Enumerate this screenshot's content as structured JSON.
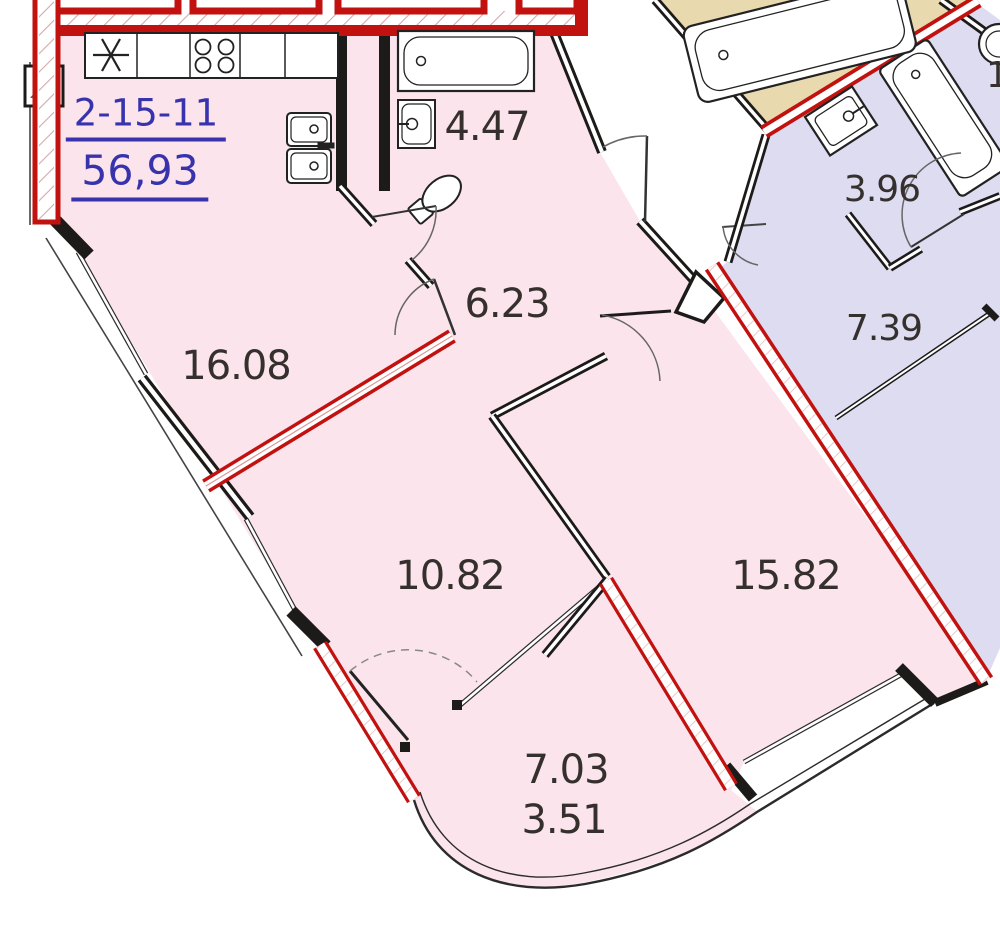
{
  "plan": {
    "unit": {
      "id": "2-15-11",
      "total_area": "56,93"
    },
    "rooms": [
      {
        "key": "living-room",
        "area": "16.08"
      },
      {
        "key": "hallway",
        "area": "6.23"
      },
      {
        "key": "bathroom",
        "area": "4.47"
      },
      {
        "key": "bedroom",
        "area": "10.82"
      },
      {
        "key": "room",
        "area": "15.82"
      },
      {
        "key": "balcony",
        "area": "7.03",
        "area_reduced": "3.51"
      },
      {
        "key": "neighbor-bathroom",
        "area": "3.96"
      },
      {
        "key": "neighbor-room",
        "area": "7.39"
      },
      {
        "key": "neighbor-partial",
        "area": "1"
      }
    ],
    "colors": {
      "apartment_fill": "#fbe4ec",
      "neighbor_fill": "#dddcf1",
      "tan_fill": "#e9d9ae",
      "wall_red": "#c21210",
      "wall_black": "#1d1b1a",
      "label_blue": "#3833ad",
      "label_dark": "#35302d"
    }
  }
}
